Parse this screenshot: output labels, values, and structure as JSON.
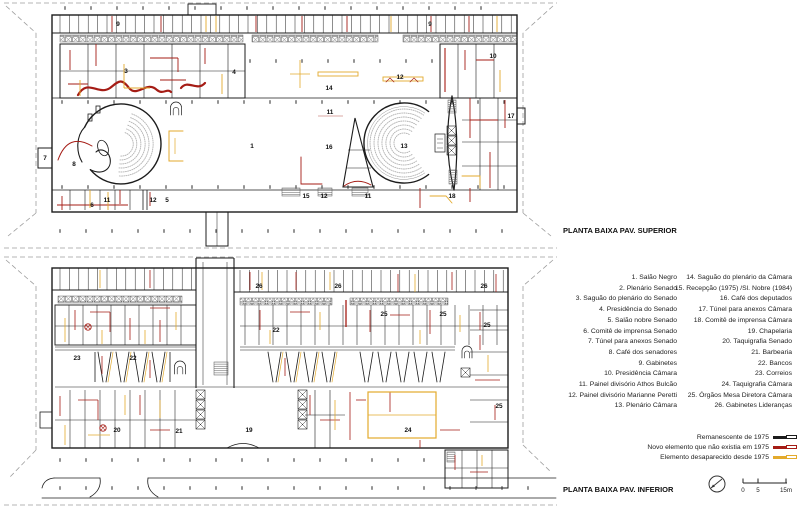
{
  "document": {
    "upper_plan_title": "PLANTA BAIXA PAV. SUPERIOR",
    "lower_plan_title": "PLANTA BAIXA PAV. INFERIOR"
  },
  "legend": {
    "rooms_col1": [
      "1.  Salão Negro",
      "2.  Plenário Senado",
      "3.  Saguão do plenário do Senado",
      "4.  Presidência do Senado",
      "5.  Salão nobre Senado",
      "6.  Comitê de imprensa Senado",
      "7.  Túnel para anexos Senado",
      "8.  Café dos senadores",
      "9.  Gabinetes",
      "10.  Presidência Câmara",
      "11.  Painel divisório Athos Bulcão",
      "12.  Painel divisório Marianne Peretti",
      "13.  Plenário Câmara"
    ],
    "rooms_col2": [
      "14.  Saguão do plenário da Câmara",
      "15. Recepção (1975) /Sl. Nobre (1984)",
      "16. Café dos deputados",
      "17. Túnel para anexos Câmara",
      "18.  Comitê de imprensa Câmara",
      "19. Chapelaria",
      "20. Taquigrafia Senado",
      "21. Barbearia",
      "22. Bancos",
      "23. Correios",
      "24. Taquigrafia Câmara",
      "25. Órgãos Mesa Diretora Câmara",
      "26. Gabinetes Lideranças"
    ],
    "colors": [
      {
        "label": "Remanescente de 1975",
        "color": "#1c1c1c"
      },
      {
        "label": "Novo elemento que não existia em 1975",
        "color": "#a51c15"
      },
      {
        "label": "Elemento desaparecido desde 1975",
        "color": "#e3aa2c"
      }
    ]
  },
  "scalebar": {
    "ticks": [
      {
        "label": "0",
        "x": 743
      },
      {
        "label": "5",
        "x": 758
      },
      {
        "label": "15m",
        "x": 786
      }
    ]
  },
  "icons": {
    "north_arrow": "north-arrow-icon"
  },
  "palette": {
    "wall": "#1c1c1c",
    "new_1975": "#a51c15",
    "gone_1975": "#e3aa2c",
    "boundary": "#9e9e9e",
    "seats": "#b3b3b3"
  },
  "upper_plan_labels": [
    {
      "t": "9",
      "x": 118,
      "y": 26
    },
    {
      "t": "9",
      "x": 430,
      "y": 26
    },
    {
      "t": "3",
      "x": 126,
      "y": 73
    },
    {
      "t": "4",
      "x": 234,
      "y": 74
    },
    {
      "t": "10",
      "x": 493,
      "y": 58
    },
    {
      "t": "12",
      "x": 400,
      "y": 79
    },
    {
      "t": "14",
      "x": 329,
      "y": 90
    },
    {
      "t": "11",
      "x": 330,
      "y": 114
    },
    {
      "t": "16",
      "x": 329,
      "y": 149
    },
    {
      "t": "1",
      "x": 252,
      "y": 148
    },
    {
      "t": "13",
      "x": 404,
      "y": 148
    },
    {
      "t": "17",
      "x": 511,
      "y": 118
    },
    {
      "t": "7",
      "x": 45,
      "y": 160
    },
    {
      "t": "8",
      "x": 74,
      "y": 166
    },
    {
      "t": "6",
      "x": 92,
      "y": 207
    },
    {
      "t": "11",
      "x": 107,
      "y": 202
    },
    {
      "t": "12",
      "x": 153,
      "y": 202
    },
    {
      "t": "5",
      "x": 167,
      "y": 202
    },
    {
      "t": "15",
      "x": 306,
      "y": 198
    },
    {
      "t": "12",
      "x": 324,
      "y": 198
    },
    {
      "t": "11",
      "x": 368,
      "y": 198
    },
    {
      "t": "18",
      "x": 452,
      "y": 198
    }
  ],
  "lower_plan_labels": [
    {
      "t": "26",
      "x": 259,
      "y": 288
    },
    {
      "t": "26",
      "x": 338,
      "y": 288
    },
    {
      "t": "26",
      "x": 484,
      "y": 288
    },
    {
      "t": "25",
      "x": 384,
      "y": 316
    },
    {
      "t": "25",
      "x": 443,
      "y": 316
    },
    {
      "t": "25",
      "x": 487,
      "y": 327
    },
    {
      "t": "25",
      "x": 499,
      "y": 408
    },
    {
      "t": "22",
      "x": 276,
      "y": 332
    },
    {
      "t": "23",
      "x": 77,
      "y": 360
    },
    {
      "t": "22",
      "x": 133,
      "y": 360
    },
    {
      "t": "20",
      "x": 117,
      "y": 432
    },
    {
      "t": "21",
      "x": 179,
      "y": 433
    },
    {
      "t": "19",
      "x": 249,
      "y": 432
    },
    {
      "t": "24",
      "x": 408,
      "y": 432
    }
  ]
}
